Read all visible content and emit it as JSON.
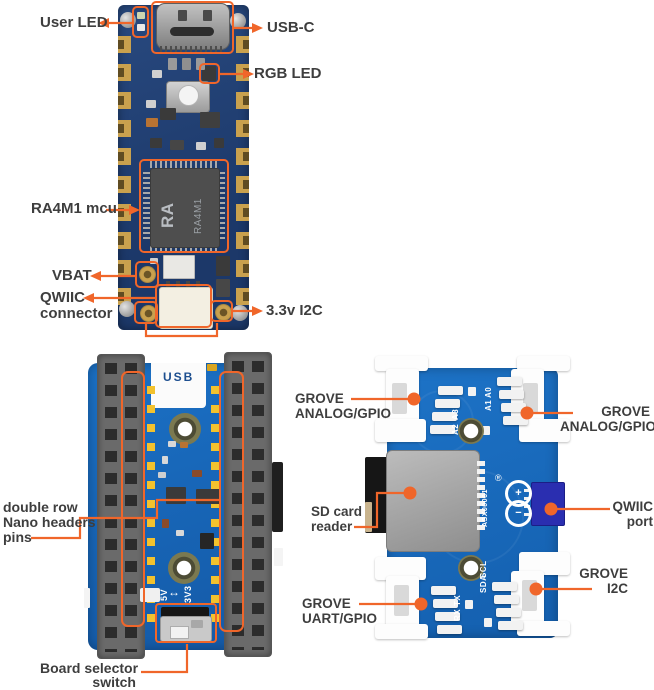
{
  "colors": {
    "accent_orange": "#f0662a",
    "label_text": "#3e3e3e",
    "pcb_navy": "#23457b",
    "pcb_blue": "#176dc1",
    "gold_pad": "#c9a14e",
    "qwiic_connector_blue": "#2a2eb0"
  },
  "nano": {
    "user_led": "User LED",
    "usb_c": "USB-C",
    "rgb_led": "RGB LED",
    "mcu": "RA4M1 mcu",
    "vbat": "VBAT",
    "qwiic_line1": "QWIIC",
    "qwiic_line2": "connector",
    "i2c_3v3": "3.3v I2C",
    "chip_logo": "RA",
    "chip_part": "RA4M1"
  },
  "header_board": {
    "usb": "USB",
    "pins_line1": "double row",
    "pins_line2": "Nano headers",
    "pins_line3": "pins",
    "switch_line1": "Board selector",
    "switch_line2": "switch",
    "v5": "5V",
    "swap_arrow": "↔",
    "v3": "3V3"
  },
  "carrier": {
    "grove_left_line1": "GROVE",
    "grove_left_line2": "ANALOG/GPIO",
    "grove_right_line1": "GROVE",
    "grove_right_line2": "ANALOG/GPIO",
    "sd_line1": "SD card",
    "sd_line2": "reader",
    "qwiic_line1": "QWIIC",
    "qwiic_line2": "port",
    "uart_line1": "GROVE",
    "uart_line2": "UART/GPIO",
    "i2c_line1": "GROVE",
    "i2c_line2": "I2C",
    "pin_a3": "A3",
    "pin_a2": "A2",
    "pin_a0": "A0",
    "pin_a1": "A1",
    "pin_scl": "SCL",
    "pin_sda": "SDA",
    "pin_tx": "TX",
    "pin_rx": "RX",
    "part_number": "ASX00061",
    "registered_mark": "®",
    "logo_plus": "+",
    "logo_minus": "−"
  }
}
